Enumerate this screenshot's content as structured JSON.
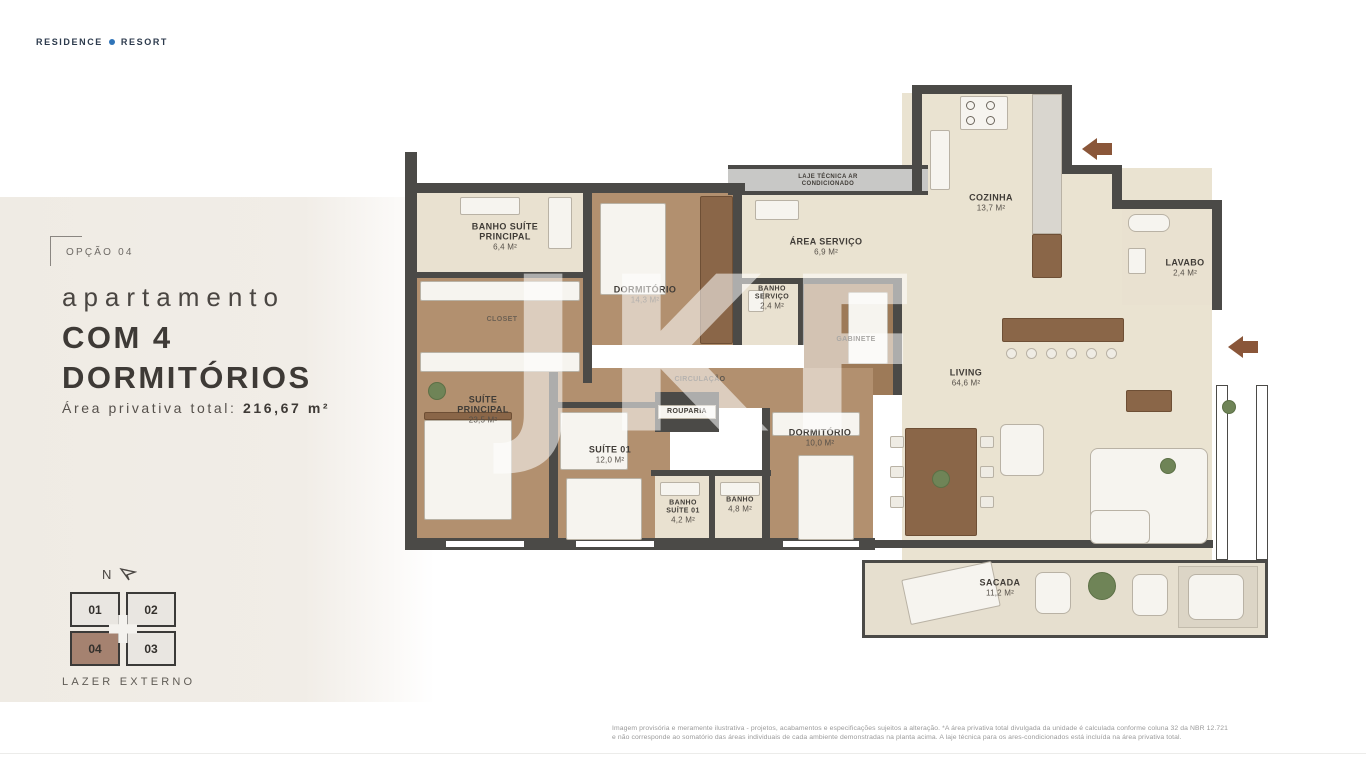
{
  "brand": {
    "left": "RESIDENCE",
    "right": "RESORT",
    "dot_color": "#2f74b8"
  },
  "panel": {
    "option": "OPÇÃO 04",
    "subtitle": "apartamento",
    "title_line1": "COM 4",
    "title_line2": "DORMITÓRIOS",
    "area_label": "Área privativa total:",
    "area_value": "216,67 m²"
  },
  "keyplan": {
    "north": "N",
    "units": [
      {
        "label": "01",
        "highlighted": false
      },
      {
        "label": "02",
        "highlighted": false
      },
      {
        "label": "04",
        "highlighted": true
      },
      {
        "label": "03",
        "highlighted": false
      }
    ],
    "caption": "LAZER EXTERNO",
    "highlight_color": "#a58270"
  },
  "floorplan": {
    "watermark": "JKF",
    "rooms": {
      "banho_suite_principal": {
        "label": "BANHO SUÍTE PRINCIPAL",
        "area": "6,4 m²"
      },
      "closet": {
        "label": "CLOSET"
      },
      "dormitorio_1": {
        "label": "DORMITÓRIO",
        "area": "14,3 m²"
      },
      "laje_tecnica": {
        "label": "LAJE TÉCNICA AR CONDICIONADO"
      },
      "area_servico": {
        "label": "ÁREA SERVIÇO",
        "area": "6,9 m²"
      },
      "banho_servico": {
        "label": "BANHO SERVIÇO",
        "area": "2,4 m²"
      },
      "gabinete": {
        "label": "GABINETE"
      },
      "cozinha": {
        "label": "COZINHA",
        "area": "13,7 m²"
      },
      "lavabo": {
        "label": "LAVABO",
        "area": "2,4 m²"
      },
      "living": {
        "label": "LIVING",
        "area": "64,6 m²"
      },
      "suite_principal": {
        "label": "SUÍTE PRINCIPAL",
        "area": "23,5 m²"
      },
      "suite_01": {
        "label": "SUÍTE 01",
        "area": "12,0 m²"
      },
      "circulacao": {
        "label": "CIRCULAÇÃO"
      },
      "rouparia": {
        "label": "ROUPARIA"
      },
      "dormitorio_2": {
        "label": "DORMITÓRIO",
        "area": "10,0 m²"
      },
      "banho_suite_01": {
        "label": "BANHO SUÍTE 01",
        "area": "4,2 m²"
      },
      "banho": {
        "label": "BANHO",
        "area": "4,8 m²"
      },
      "sacada": {
        "label": "SACADA",
        "area": "11,2 m²"
      }
    },
    "wall_color": "#4b4a47",
    "entrance_arrow_color": "#8a5639"
  },
  "disclaimer": {
    "line1": "Imagem provisória e meramente ilustrativa - projetos, acabamentos e especificações sujeitos a alteração. *A área privativa total divulgada da unidade é calculada conforme coluna 32 da NBR 12.721",
    "line2": "e não corresponde ao somatório das áreas individuais de cada ambiente demonstradas na planta acima. A laje técnica para os ares-condicionados está incluída na área privativa total."
  }
}
